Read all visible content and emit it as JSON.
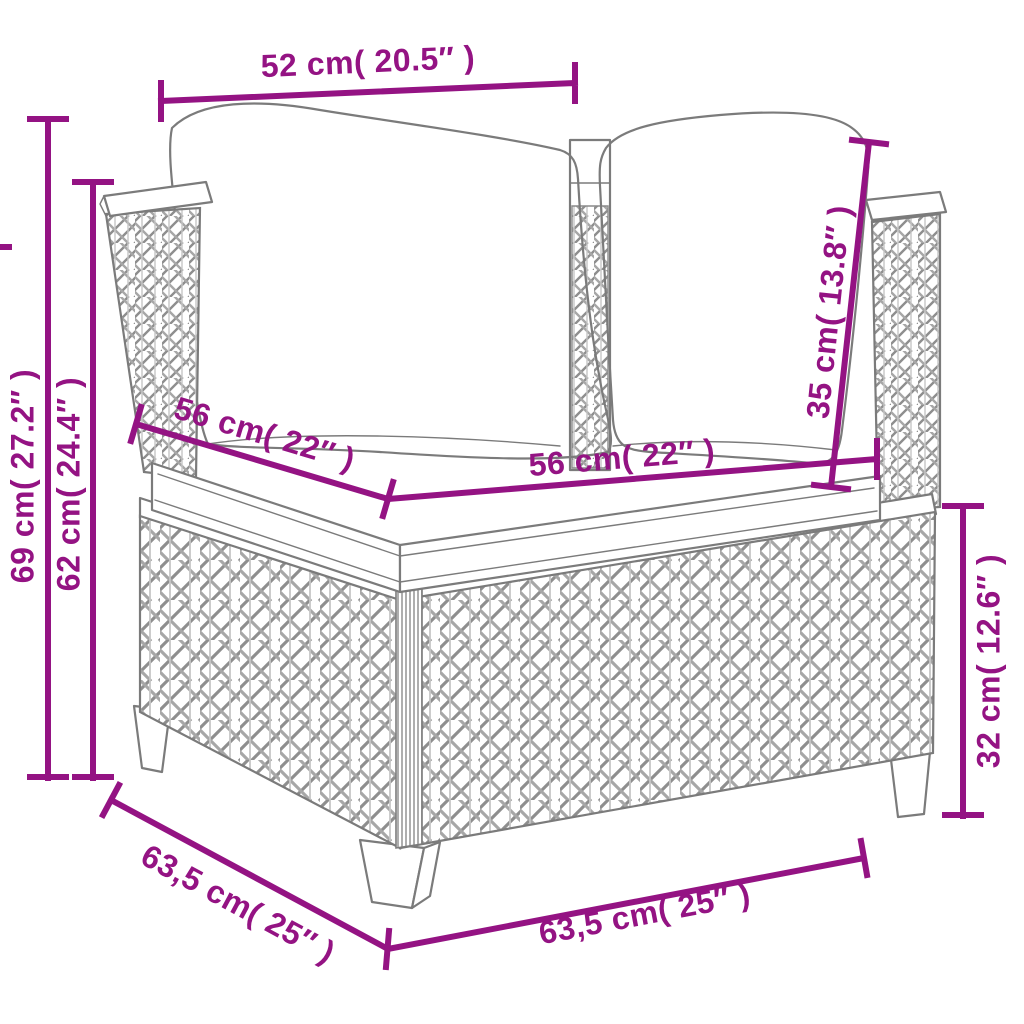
{
  "colors": {
    "dimension_accent": "#941383",
    "line_art": "#7b7b7b",
    "background": "#ffffff"
  },
  "dimensions": {
    "top_width": {
      "label": "52 cm( 20.5″ )"
    },
    "overall_height": {
      "label": "69 cm( 27.2″ )"
    },
    "arm_height": {
      "label": "62 cm( 24.4″ )"
    },
    "seat_depth": {
      "label": "56 cm( 22″ )"
    },
    "seat_width": {
      "label": "56 cm( 22″ )"
    },
    "back_cushion_height": {
      "label": "35 cm( 13.8″ )"
    },
    "base_height": {
      "label": "32 cm( 12.6″ )"
    },
    "base_depth": {
      "label": "63,5 cm( 25″ )"
    },
    "base_width": {
      "label": "63,5 cm( 25″ )"
    }
  }
}
